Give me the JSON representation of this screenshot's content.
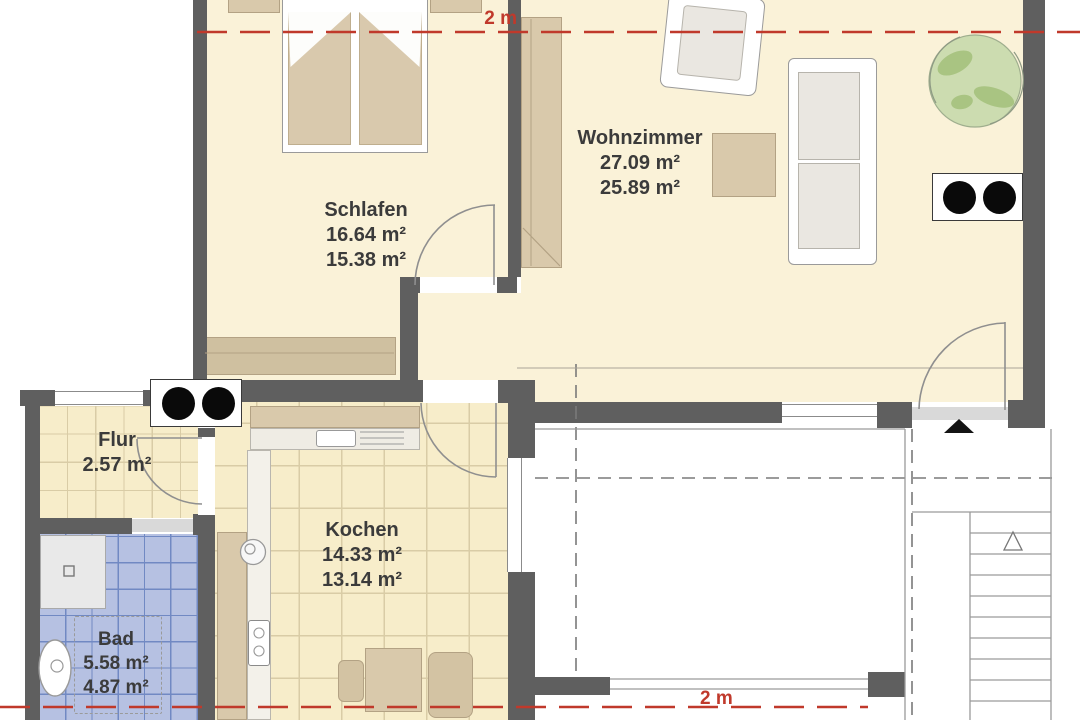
{
  "plan_type": "floor-plan",
  "rooms": {
    "schlafen": {
      "name": "Schlafen",
      "area1": "16.64 m²",
      "area2": "15.38 m²"
    },
    "wohnzimmer": {
      "name": "Wohnzimmer",
      "area1": "27.09 m²",
      "area2": "25.89 m²"
    },
    "flur": {
      "name": "Flur",
      "area1": "2.57 m²"
    },
    "kochen": {
      "name": "Kochen",
      "area1": "14.33 m²",
      "area2": "13.14 m²"
    },
    "bad": {
      "name": "Bad",
      "area1": "5.58 m²",
      "area2": "4.87 m²"
    }
  },
  "dimensions": {
    "section_line_top": "2 m",
    "section_line_bottom": "2 m"
  },
  "symbols": {
    "burner_panel": "panel with two black dots",
    "entrance_marker": "filled triangle pointing up",
    "stairs_direction": "outlined triangle pointing up",
    "plant": "round green plant"
  },
  "colors": {
    "wall": "#5f5f5f",
    "floor": "#faf2d8",
    "tile_floor": "#f7edca",
    "tile_line": "#d9cca6",
    "bad_floor": "#b6c1e2",
    "bad_tile_line": "#7189c3",
    "furniture": "#d9c9ab",
    "furniture_line": "#b3a284",
    "accent_red": "#c0392b",
    "text": "#3b3b3b",
    "plant_green": "#ccdcb0"
  }
}
